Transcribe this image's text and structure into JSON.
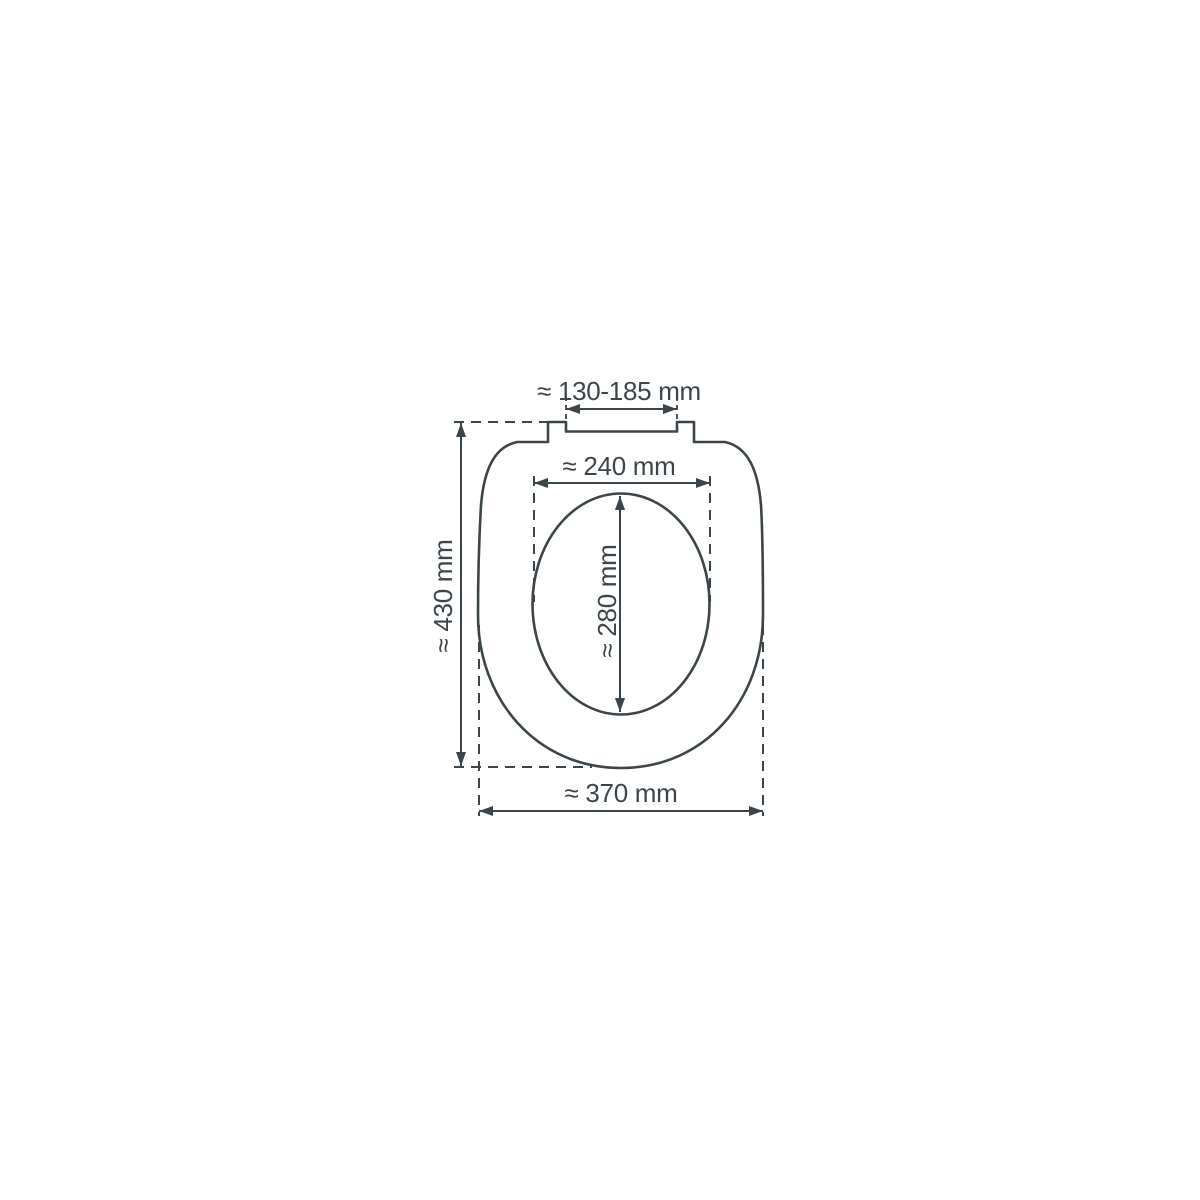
{
  "diagram": {
    "background_color": "#ffffff",
    "line_color": "#3c464a",
    "labels": {
      "hinge_width": "≈ 130-185 mm",
      "inner_width": "≈ 240 mm",
      "inner_depth": "≈ 280 mm",
      "overall_depth": "≈ 430 mm",
      "overall_width": "≈ 370 mm"
    }
  }
}
